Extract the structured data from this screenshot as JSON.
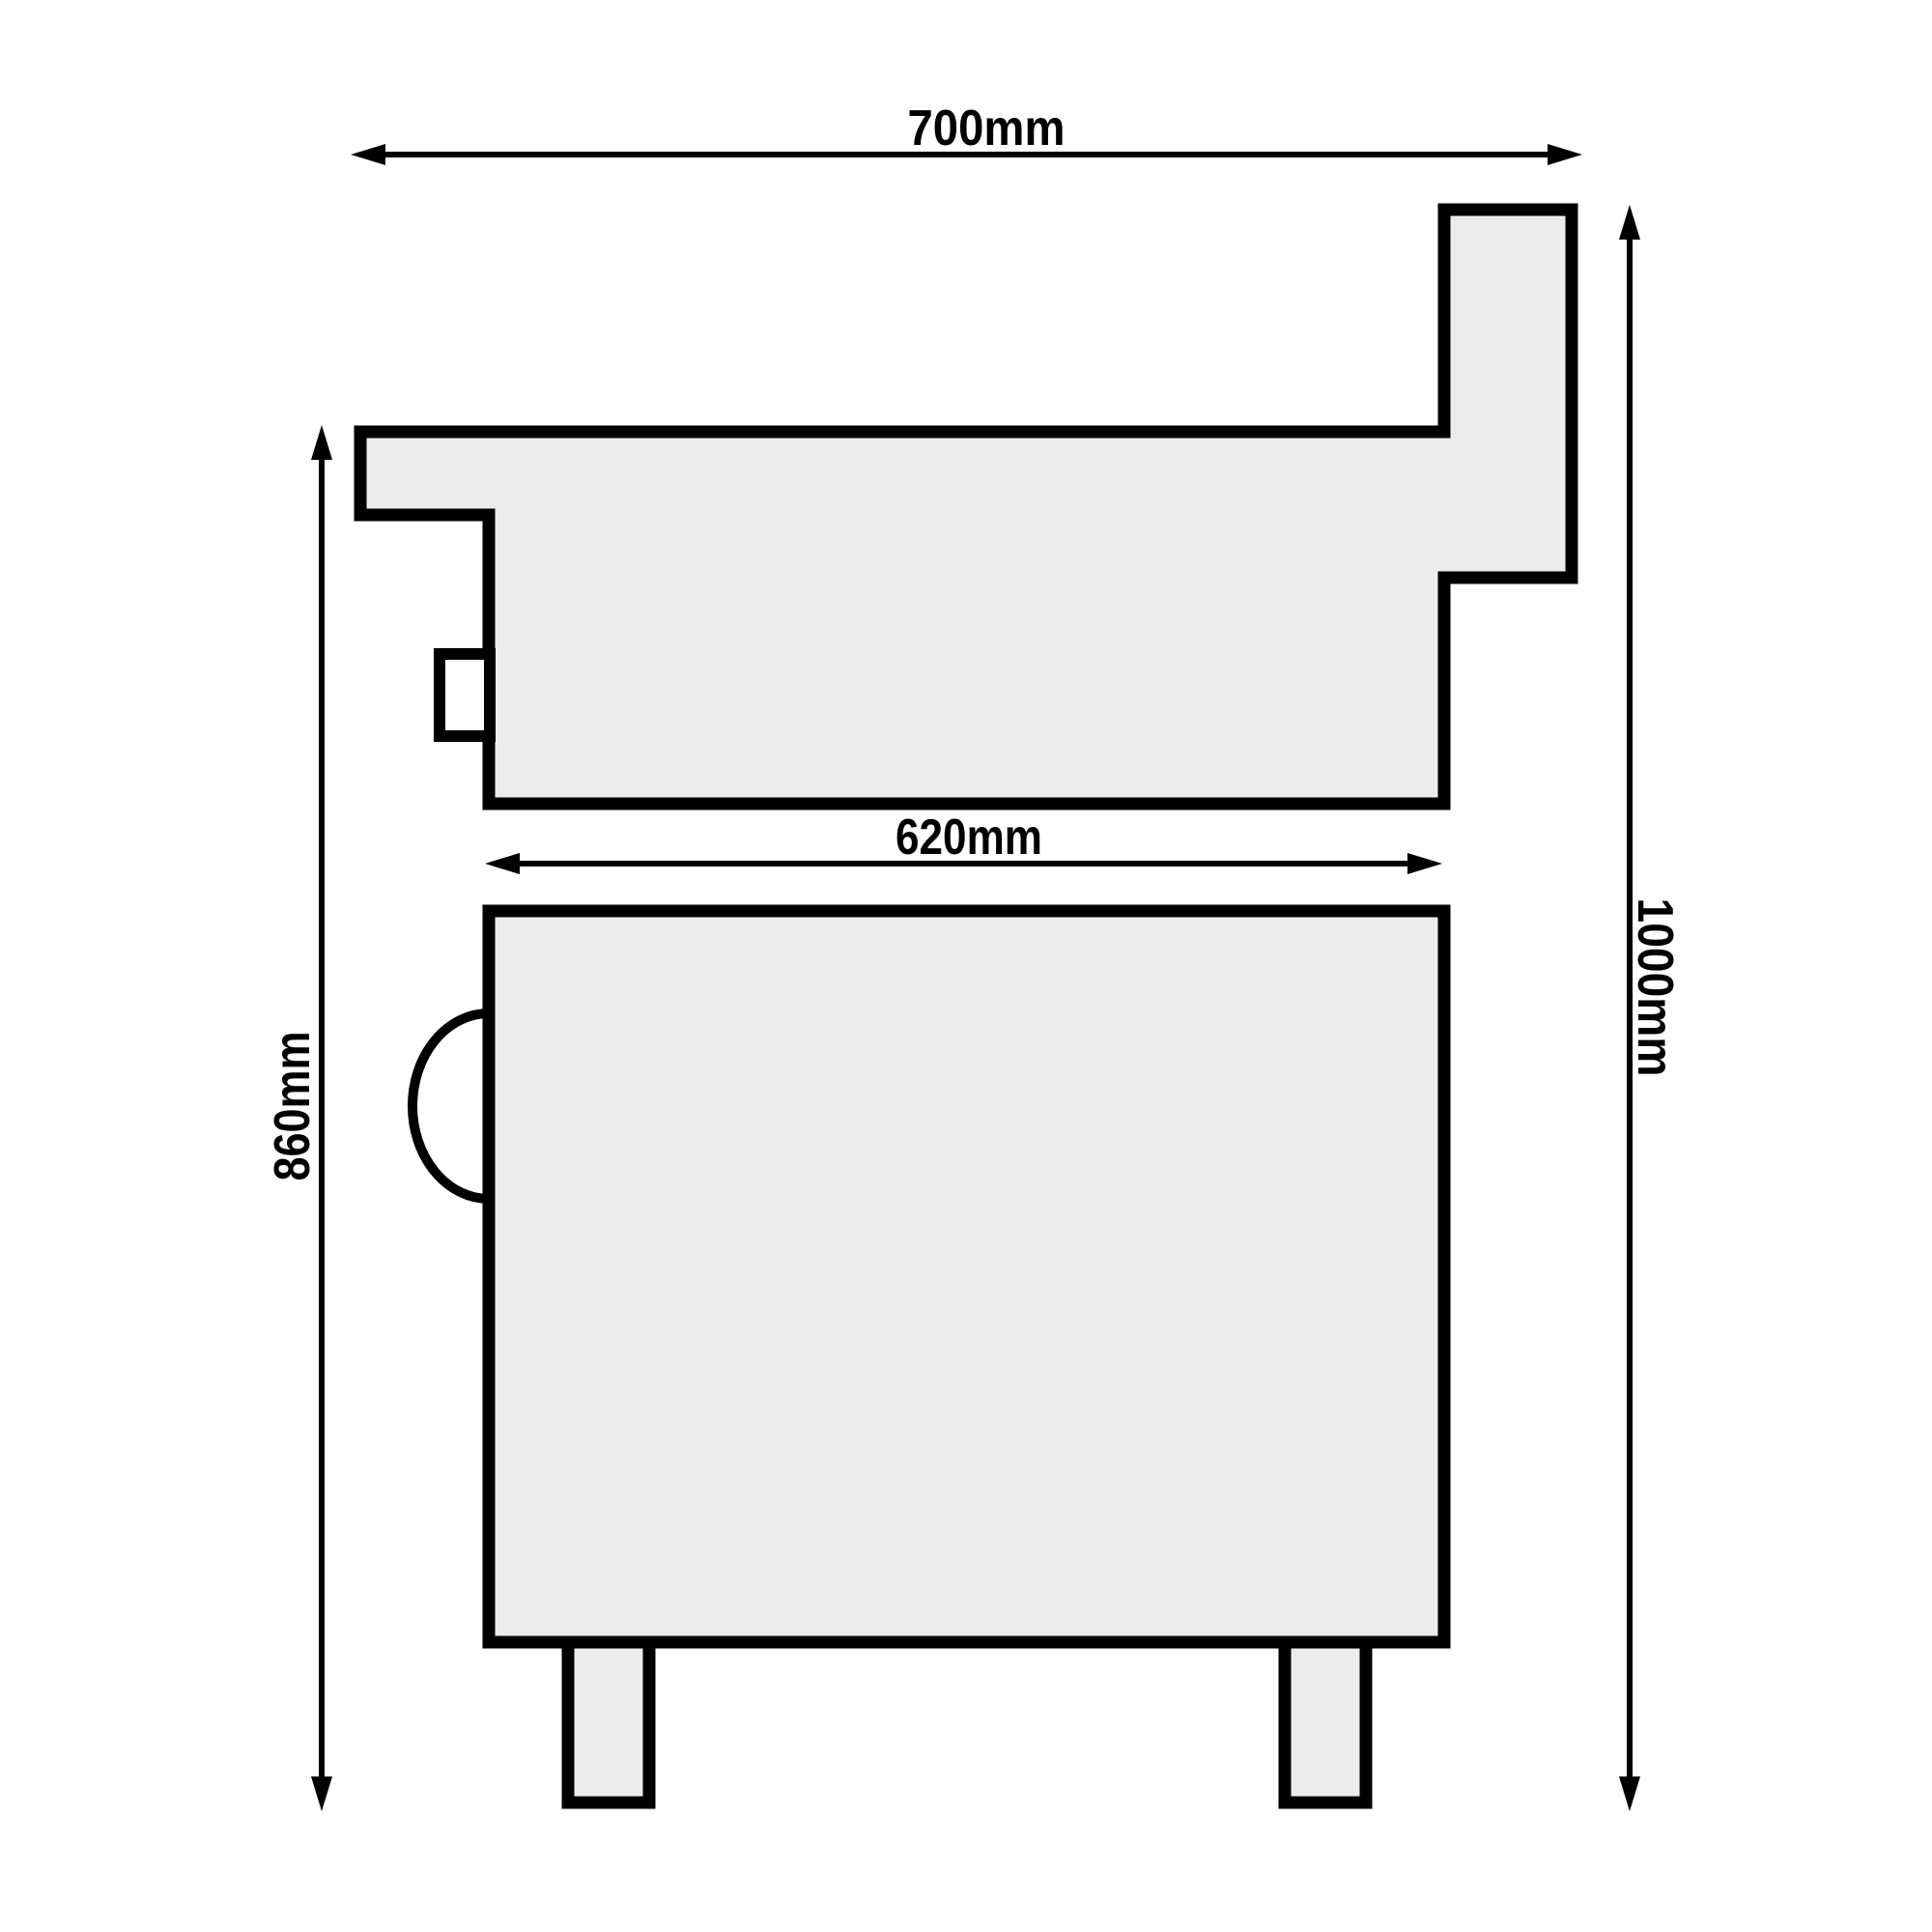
{
  "drawing": {
    "title": "Appliance side-view dimension drawing",
    "unit": "mm",
    "colors": {
      "background": "#ffffff",
      "outline": "#000000",
      "shape_fill": "#ececec",
      "cutout_fill": "#ffffff"
    },
    "dimensions": {
      "top_width": {
        "label": "700mm",
        "value": 700,
        "orientation": "horizontal"
      },
      "lower_body_width": {
        "label": "620mm",
        "value": 620,
        "orientation": "horizontal"
      },
      "lower_body_height": {
        "label": "860mm",
        "value": 860,
        "orientation": "vertical"
      },
      "total_height": {
        "label": "1000mm",
        "value": 1000,
        "orientation": "vertical"
      }
    },
    "parts": {
      "upper_unit": "countertop-unit-profile",
      "chimney": "back-splash-chimney",
      "knob": "side-control-knob",
      "lower_unit": "base-cabinet",
      "handle": "side-handle",
      "feet": "support-feet"
    }
  }
}
